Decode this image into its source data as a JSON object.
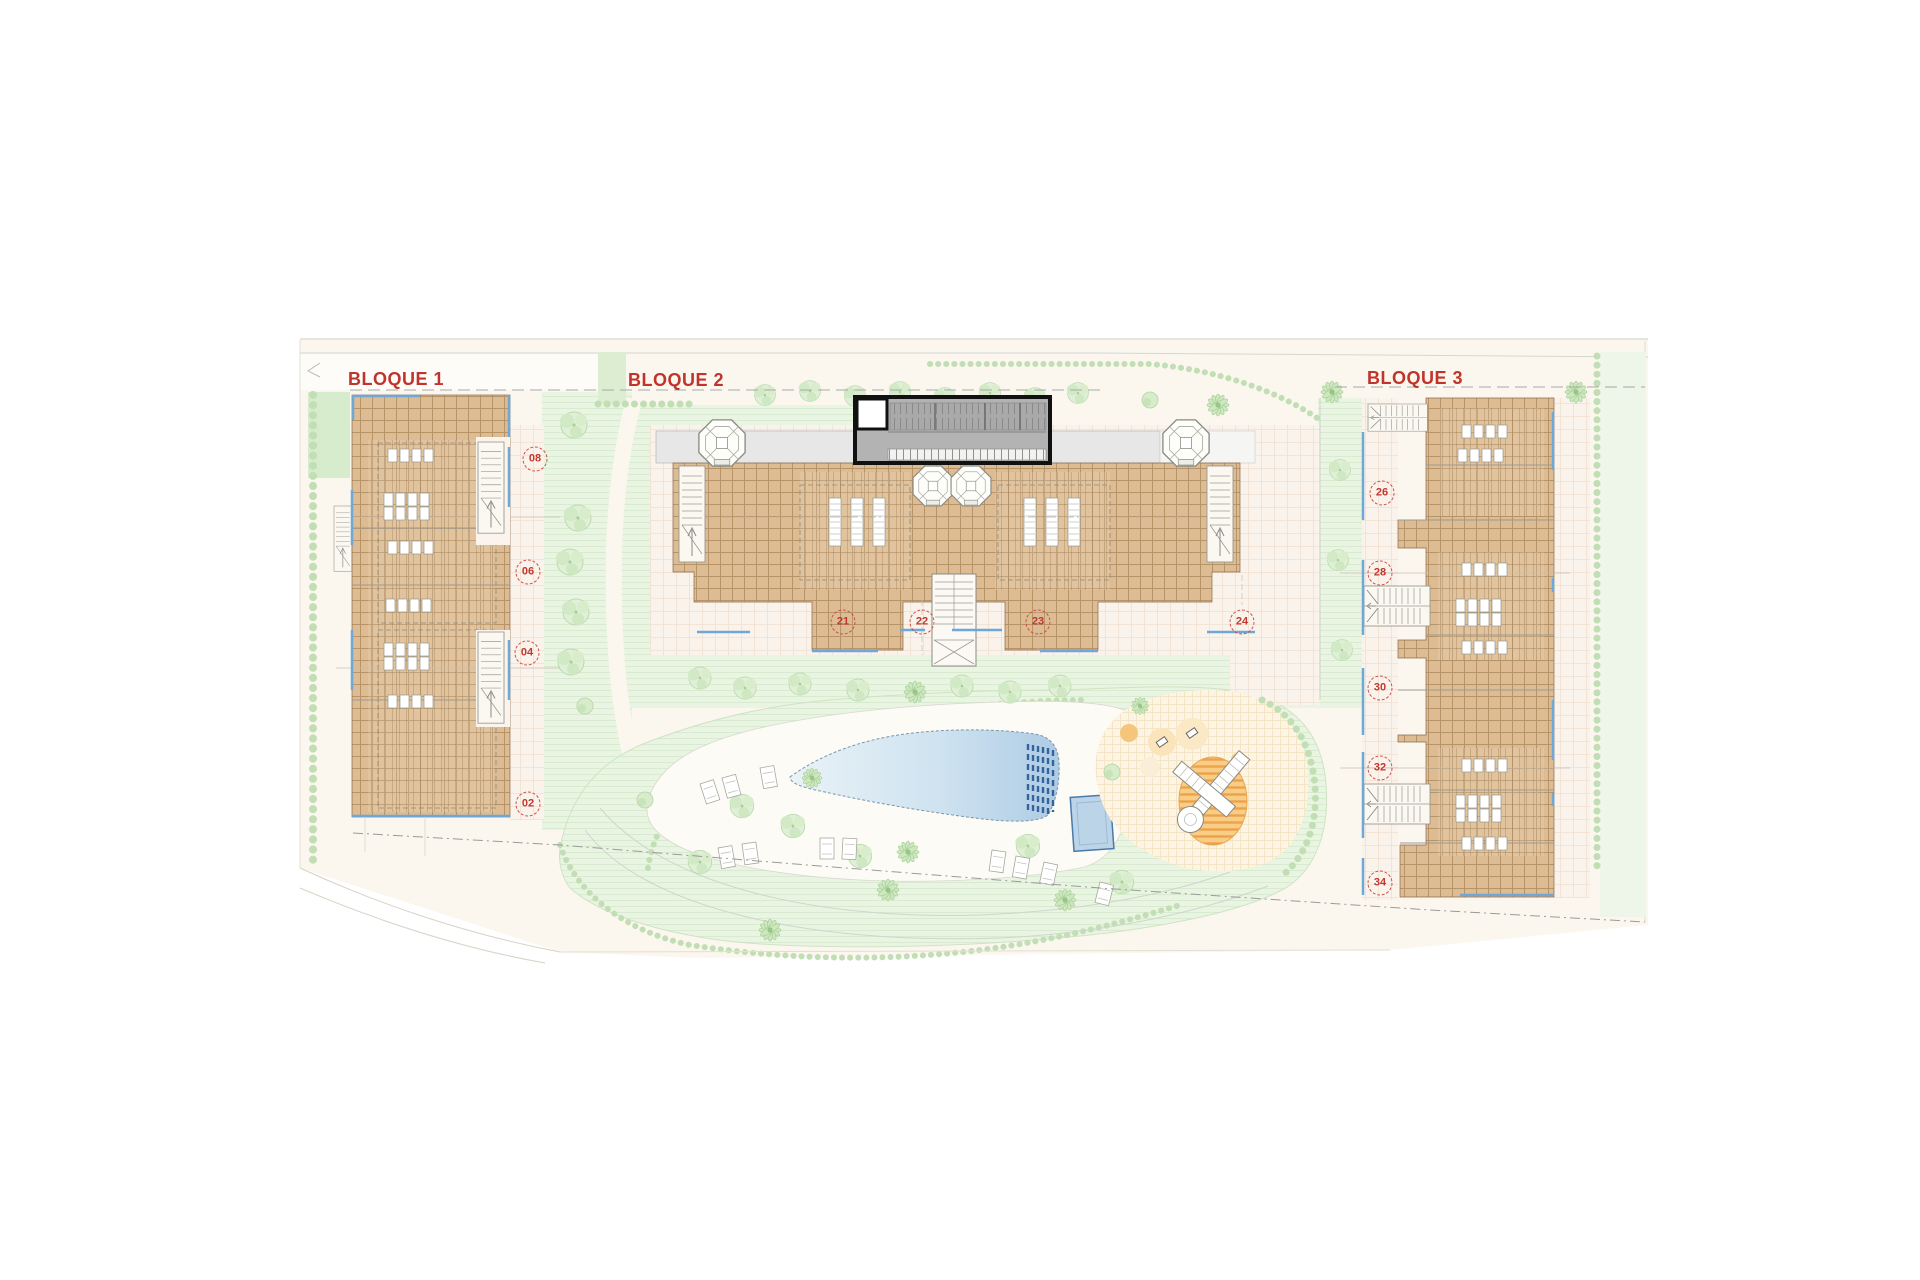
{
  "plan": {
    "blocks": [
      {
        "label": "BLOQUE 1",
        "units": [
          "08",
          "06",
          "04",
          "02"
        ]
      },
      {
        "label": "BLOQUE 2",
        "units": [
          "21",
          "22",
          "23",
          "24"
        ]
      },
      {
        "label": "BLOQUE 3",
        "units": [
          "26",
          "28",
          "30",
          "32",
          "34"
        ]
      }
    ],
    "colors": {
      "label_red": "#c0342c",
      "badge_red": "#cc4038",
      "roof_tan": "#ddbb93",
      "roof_grid": "#aa8759",
      "lawn_green": "#eaf4e2",
      "hedge_green": "#c2deb4",
      "pool_light": "#e6f1f7",
      "pool_dark": "#b3cfe6",
      "lane_blue": "#34639e",
      "edge_blue": "#6fa8d6",
      "structure_gray": "#b3b3b3",
      "playground_orange": "#f7bb66"
    }
  }
}
